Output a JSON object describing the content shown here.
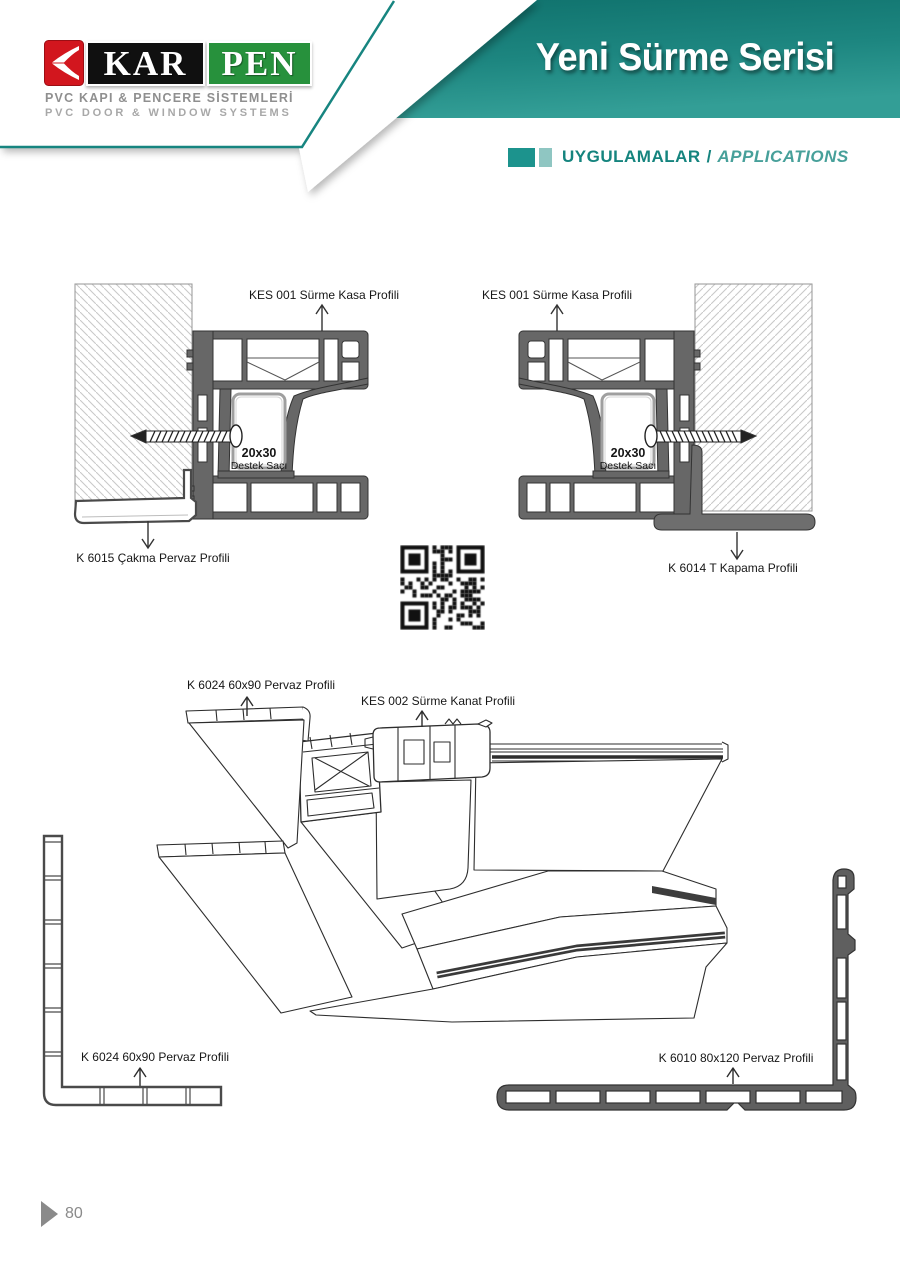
{
  "brand": {
    "kar": "KAR",
    "pen": "PEN",
    "tagline_tr": "PVC KAPI & PENCERE SİSTEMLERİ",
    "tagline_en": "PVC DOOR & WINDOW SYSTEMS"
  },
  "header": {
    "title": "Yeni Sürme Serisi",
    "section_tr": "UYGULAMALAR",
    "section_divider": "/",
    "section_en": "APPLICATIONS"
  },
  "sections": {
    "top_left": {
      "frame_label": "KES 001 Sürme Kasa Profili",
      "support_size": "20x30",
      "support_name": "Destek Sacı",
      "trim_label": "K 6015 Çakma Pervaz Profili"
    },
    "top_right": {
      "frame_label": "KES 001 Sürme Kasa Profili",
      "support_size": "20x30",
      "support_name": "Destek Sacı",
      "cap_label": "K 6014 T Kapama Profili"
    },
    "iso": {
      "casing_label_top": "K 6024 60x90 Pervaz Profili",
      "sash_label": "KES 002 Sürme Kanat Profili",
      "casing_label_bottom": "K 6024 60x90 Pervaz Profili",
      "casing_label_right": "K 6010 80x120 Pervaz Profili"
    }
  },
  "icons": {
    "logo_mark": "karpen-arrow-mark",
    "qr": "qr-code"
  },
  "colors": {
    "banner_teal_dark": "#0f716c",
    "banner_teal": "#1d8680",
    "banner_teal_light": "#339e96",
    "pinstripe_teal": "#178580",
    "section_teal": "#15847e",
    "section_teal_light": "#8fc6c2",
    "logo_red": "#d2161e",
    "logo_green": "#27913c",
    "logo_black": "#101010",
    "gray_text": "#8f8f8f",
    "profile_gray": "#676767"
  },
  "footer": {
    "page_number": "80"
  }
}
